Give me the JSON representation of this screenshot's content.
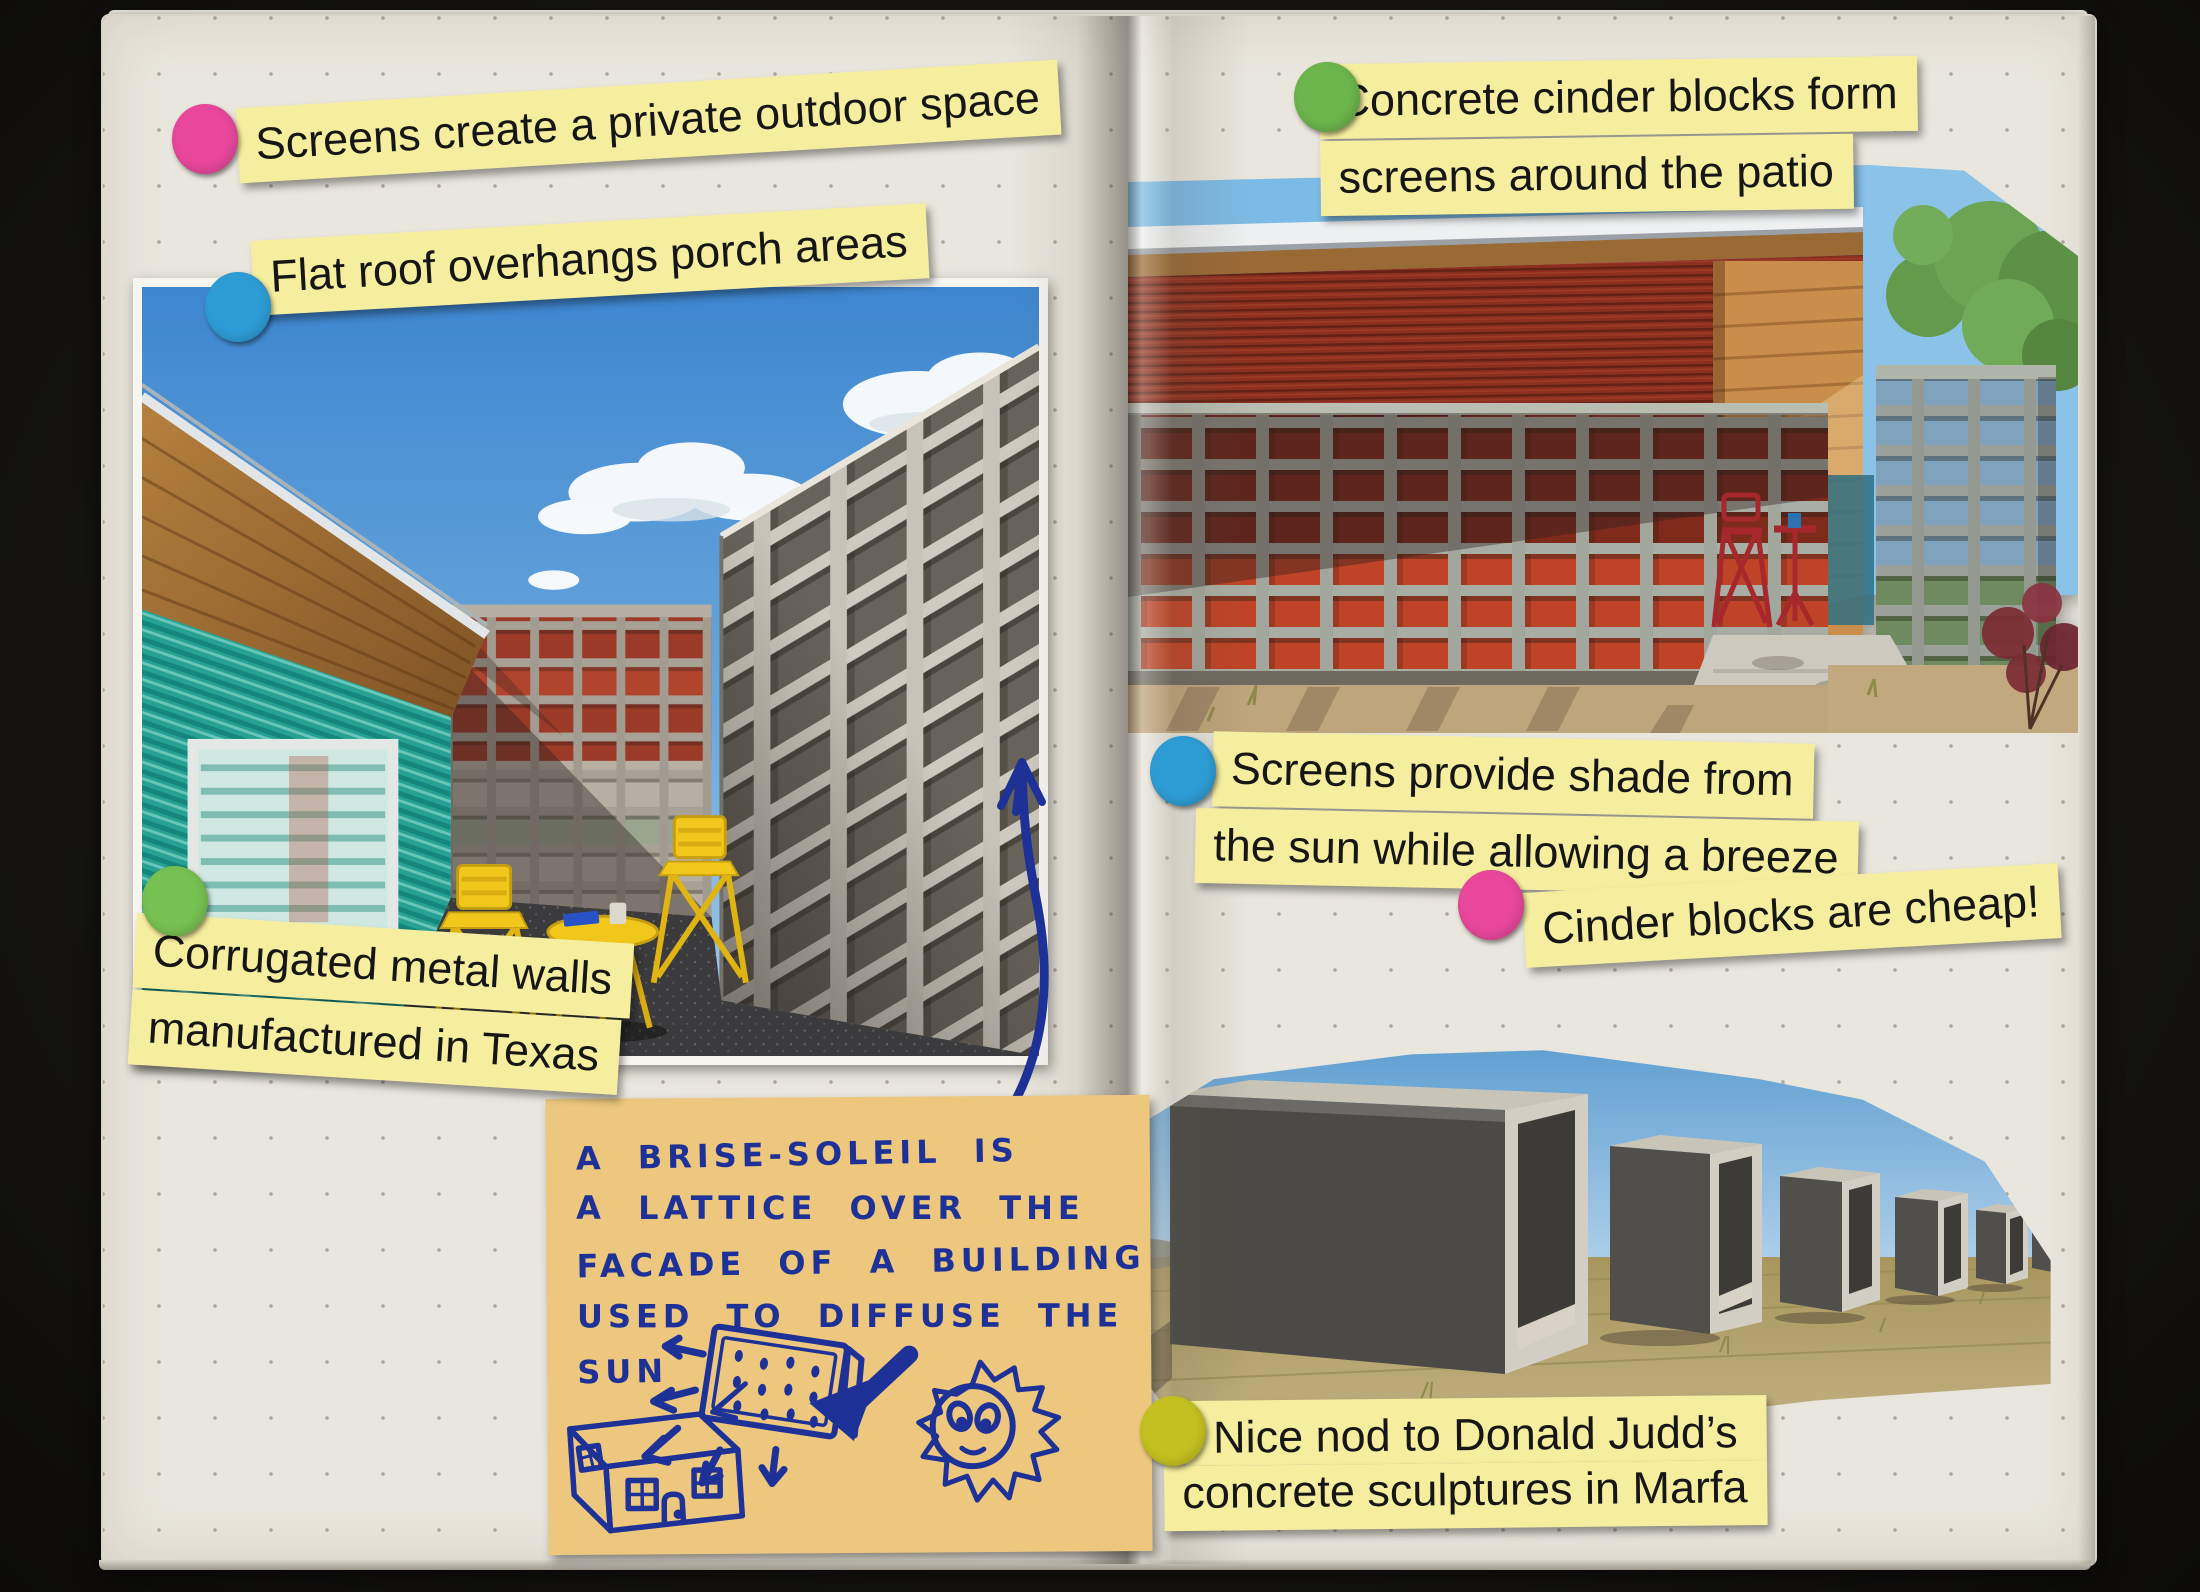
{
  "window": {
    "background_color": "#141311"
  },
  "notebook": {
    "paper_color": "#e9e6dd",
    "dot_grid_color": "#7d7062",
    "type": "dot-grid journal spread, two pages"
  },
  "sticker_dots": [
    {
      "name": "pink-dot-screens",
      "color": "#e8479b"
    },
    {
      "name": "blue-dot-flat-roof",
      "color": "#2e9cd4"
    },
    {
      "name": "green-dot-corrugated",
      "color": "#77c052"
    },
    {
      "name": "green-dot-cinder",
      "color": "#6cb44c"
    },
    {
      "name": "blue-dot-shade",
      "color": "#2e9cd4"
    },
    {
      "name": "pink-dot-cheap",
      "color": "#e8479b"
    },
    {
      "name": "olive-dot-judd",
      "color": "#c3c021"
    }
  ],
  "sticky_notes": {
    "color": "#f5ee9e",
    "screens_private": "Screens create a private outdoor space",
    "flat_roof": "Flat roof overhangs porch areas",
    "corrugated_line1": "Corrugated metal walls",
    "corrugated_line2": "manufactured in Texas",
    "cinder_form_line1": "Concrete cinder blocks form",
    "cinder_form_line2": "screens around the patio",
    "shade_line1": "Screens provide shade from",
    "shade_line2": "the sun while allowing a breeze",
    "cheap": "Cinder blocks are cheap!",
    "judd_line1": "Nice nod to Donald Judd’s",
    "judd_line2": "concrete sculptures in Marfa"
  },
  "handwritten_note": {
    "paper_color": "#edc77e",
    "ink_color": "#1d3197",
    "lines": [
      "A  BRISE-SOLEIL  IS",
      "A  LATTICE  OVER THE",
      "FACADE  OF  A  BUILDING",
      "USED  TO  DIFFUSE  THE",
      "SUN"
    ],
    "doodle": "sun shining onto a dotted lattice panel that diffuses rays toward a small house"
  },
  "photos": [
    {
      "name": "courtyard-photo",
      "alt": "Courtyard with teal corrugated metal wall, concrete cinder-block screen walls, wood roof soffit and yellow bistro table set"
    },
    {
      "name": "patio-photo",
      "alt": "Cinder-block screen wall in front of red corrugated metal, cedar-clad porch with red bistro chair, tree at right"
    },
    {
      "name": "judd-photo",
      "alt": "Row of Donald Judd concrete box sculptures on dry grass in Marfa"
    }
  ]
}
